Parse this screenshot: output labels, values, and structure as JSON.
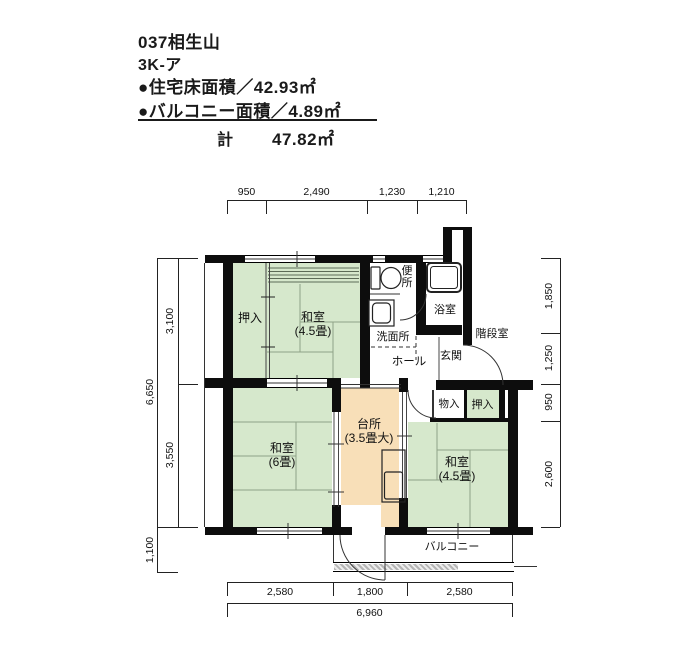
{
  "header": {
    "project": "037相生山",
    "plan_type": "3K-ア",
    "floor_area_line": "●住宅床面積／42.93㎡",
    "balcony_area_line": "●バルコニー面積／4.89㎡",
    "total_label": "計",
    "total_value": "47.82㎡"
  },
  "rooms": {
    "oshiire_top": "押入",
    "washitsu_top": {
      "name": "和室",
      "size": "(4.5畳)"
    },
    "benjo": "便所",
    "yokushitsu": "浴室",
    "senmenjo": "洗面所",
    "kaidanshitsu": "階段室",
    "genkan": "玄関",
    "hall": "ホール",
    "monoire": "物入",
    "oshiire_right": "押入",
    "kitchen": {
      "name": "台所",
      "size": "(3.5畳大)"
    },
    "washitsu6": {
      "name": "和室",
      "size": "(6畳)"
    },
    "washitsu_br": {
      "name": "和室",
      "size": "(4.5畳)"
    },
    "balcony": "バルコニー"
  },
  "dimensions": {
    "top": [
      "950",
      "2,490",
      "1,230",
      "1,210"
    ],
    "left_inner": [
      "3,100",
      "3,550"
    ],
    "left_outer": "6,650",
    "left_balcony": "1,100",
    "right": [
      "1,850",
      "1,250",
      "950",
      "2,600"
    ],
    "bottom": [
      "2,580",
      "1,800",
      "2,580"
    ],
    "bottom_total": "6,960"
  },
  "colors": {
    "tatami_green": "#d6e8cc",
    "kitchen_orange": "#f8dfb8",
    "wall_black": "#0d0d0d"
  }
}
